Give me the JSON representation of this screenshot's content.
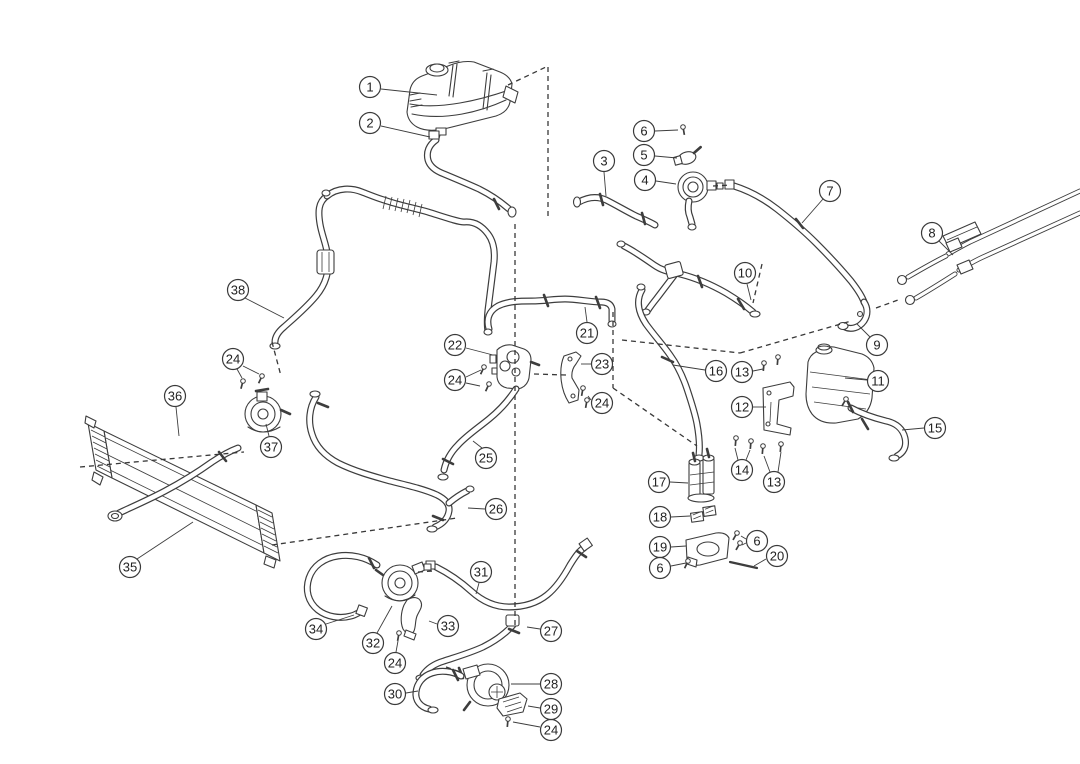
{
  "figure": {
    "canvas": {
      "width": 1080,
      "height": 764
    },
    "colors": {
      "background": "#ffffff",
      "line": "#3d3d3d",
      "callout_fill": "#ffffff",
      "callout_text": "#222222"
    },
    "callout": {
      "radius": 10.5,
      "font_size": 13
    }
  },
  "callouts": [
    {
      "label": "1",
      "x": 370,
      "y": 87,
      "leaders": [
        [
          381,
          89,
          437,
          95
        ]
      ]
    },
    {
      "label": "2",
      "x": 370,
      "y": 123,
      "leaders": [
        [
          381,
          126,
          430,
          137
        ]
      ]
    },
    {
      "label": "3",
      "x": 604,
      "y": 161,
      "leaders": [
        [
          604,
          172,
          606,
          196
        ]
      ]
    },
    {
      "label": "4",
      "x": 645,
      "y": 180,
      "leaders": [
        [
          656,
          181,
          676,
          184
        ]
      ]
    },
    {
      "label": "5",
      "x": 644,
      "y": 155,
      "leaders": [
        [
          655,
          156,
          677,
          158
        ]
      ]
    },
    {
      "label": "6",
      "x": 644,
      "y": 131,
      "leaders": [
        [
          655,
          131,
          678,
          130
        ]
      ]
    },
    {
      "label": "7",
      "x": 830,
      "y": 191,
      "leaders": [
        [
          823,
          199,
          802,
          223
        ]
      ]
    },
    {
      "label": "8",
      "x": 932,
      "y": 233,
      "leaders": [
        [
          939,
          241,
          953,
          255
        ]
      ]
    },
    {
      "label": "9",
      "x": 877,
      "y": 345,
      "leaders": [
        [
          870,
          337,
          857,
          324
        ]
      ]
    },
    {
      "label": "10",
      "x": 745,
      "y": 273,
      "leaders": [
        [
          747,
          284,
          751,
          300
        ]
      ]
    },
    {
      "label": "11",
      "x": 878,
      "y": 381,
      "leaders": [
        [
          867,
          380,
          845,
          378
        ]
      ]
    },
    {
      "label": "12",
      "x": 742,
      "y": 407,
      "leaders": [
        [
          753,
          407,
          766,
          407
        ]
      ]
    },
    {
      "label": "13",
      "x": 742,
      "y": 372,
      "leaders": [
        [
          753,
          371,
          763,
          369
        ]
      ]
    },
    {
      "label": "14",
      "x": 742,
      "y": 470,
      "leaders": [
        [
          738,
          460,
          735,
          448
        ],
        [
          746,
          460,
          750,
          450
        ]
      ]
    },
    {
      "label": "13",
      "x": 774,
      "y": 482,
      "leaders": [
        [
          770,
          472,
          764,
          456
        ],
        [
          778,
          472,
          781,
          452
        ]
      ]
    },
    {
      "label": "15",
      "x": 935,
      "y": 428,
      "leaders": [
        [
          924,
          428,
          902,
          430
        ]
      ]
    },
    {
      "label": "16",
      "x": 716,
      "y": 371,
      "leaders": [
        [
          705,
          370,
          673,
          365
        ]
      ]
    },
    {
      "label": "17",
      "x": 659,
      "y": 482,
      "leaders": [
        [
          670,
          482,
          688,
          483
        ]
      ]
    },
    {
      "label": "18",
      "x": 660,
      "y": 517,
      "leaders": [
        [
          671,
          517,
          690,
          516
        ]
      ]
    },
    {
      "label": "19",
      "x": 660,
      "y": 547,
      "leaders": [
        [
          671,
          547,
          686,
          546
        ]
      ]
    },
    {
      "label": "6",
      "x": 757,
      "y": 541,
      "leaders": [
        [
          746,
          539,
          741,
          536
        ],
        [
          746,
          543,
          742,
          545
        ]
      ]
    },
    {
      "label": "20",
      "x": 777,
      "y": 556,
      "leaders": [
        [
          766,
          559,
          754,
          566
        ]
      ]
    },
    {
      "label": "6",
      "x": 660,
      "y": 568,
      "leaders": [
        [
          671,
          566,
          686,
          563
        ]
      ]
    },
    {
      "label": "21",
      "x": 587,
      "y": 333,
      "leaders": [
        [
          587,
          322,
          585,
          307
        ]
      ]
    },
    {
      "label": "22",
      "x": 455,
      "y": 345,
      "leaders": [
        [
          466,
          348,
          493,
          355
        ]
      ]
    },
    {
      "label": "23",
      "x": 602,
      "y": 364,
      "leaders": [
        [
          591,
          364,
          581,
          364
        ]
      ]
    },
    {
      "label": "24",
      "x": 455,
      "y": 380,
      "leaders": [
        [
          466,
          377,
          481,
          370
        ],
        [
          466,
          383,
          480,
          386
        ]
      ]
    },
    {
      "label": "24",
      "x": 602,
      "y": 403,
      "leaders": [
        [
          591,
          400,
          588,
          396
        ]
      ]
    },
    {
      "label": "24",
      "x": 233,
      "y": 359,
      "leaders": [
        [
          237,
          369,
          242,
          378
        ],
        [
          243,
          366,
          259,
          374
        ]
      ]
    },
    {
      "label": "24",
      "x": 395,
      "y": 663,
      "leaders": [
        [
          396,
          652,
          398,
          641
        ]
      ]
    },
    {
      "label": "24",
      "x": 551,
      "y": 730,
      "leaders": [
        [
          540,
          727,
          513,
          722
        ]
      ]
    },
    {
      "label": "25",
      "x": 486,
      "y": 458,
      "leaders": [
        [
          482,
          448,
          473,
          441
        ]
      ]
    },
    {
      "label": "26",
      "x": 496,
      "y": 509,
      "leaders": [
        [
          485,
          509,
          468,
          508
        ]
      ]
    },
    {
      "label": "27",
      "x": 551,
      "y": 631,
      "leaders": [
        [
          540,
          629,
          527,
          627
        ]
      ]
    },
    {
      "label": "28",
      "x": 551,
      "y": 684,
      "leaders": [
        [
          540,
          684,
          511,
          684
        ]
      ]
    },
    {
      "label": "29",
      "x": 551,
      "y": 709,
      "leaders": [
        [
          540,
          708,
          528,
          706
        ]
      ]
    },
    {
      "label": "30",
      "x": 395,
      "y": 694,
      "leaders": [
        [
          406,
          693,
          418,
          691
        ]
      ]
    },
    {
      "label": "31",
      "x": 481,
      "y": 572,
      "leaders": [
        [
          479,
          583,
          476,
          594
        ]
      ]
    },
    {
      "label": "32",
      "x": 373,
      "y": 643,
      "leaders": [
        [
          377,
          633,
          392,
          606
        ]
      ]
    },
    {
      "label": "33",
      "x": 448,
      "y": 626,
      "leaders": [
        [
          437,
          624,
          429,
          621
        ]
      ]
    },
    {
      "label": "34",
      "x": 316,
      "y": 629,
      "leaders": [
        [
          326,
          624,
          354,
          615
        ]
      ]
    },
    {
      "label": "35",
      "x": 130,
      "y": 567,
      "leaders": [
        [
          137,
          559,
          193,
          522
        ]
      ]
    },
    {
      "label": "36",
      "x": 175,
      "y": 396,
      "leaders": [
        [
          176,
          407,
          179,
          436
        ]
      ]
    },
    {
      "label": "37",
      "x": 271,
      "y": 447,
      "leaders": [
        [
          269,
          436,
          266,
          424
        ]
      ]
    },
    {
      "label": "38",
      "x": 238,
      "y": 290,
      "leaders": [
        [
          245,
          298,
          284,
          318
        ]
      ]
    }
  ],
  "dashed_lines": [
    [
      508,
      85,
      546,
      67
    ],
    [
      548,
      67,
      548,
      218
    ],
    [
      515,
      224,
      515,
      625
    ],
    [
      613,
      312,
      613,
      388
    ],
    [
      613,
      388,
      697,
      446
    ],
    [
      622,
      340,
      740,
      353
    ],
    [
      740,
      353,
      851,
      321
    ],
    [
      534,
      374,
      566,
      375
    ],
    [
      713,
      186,
      731,
      185
    ],
    [
      762,
      264,
      753,
      303
    ],
    [
      876,
      308,
      898,
      300
    ],
    [
      80,
      467,
      244,
      452
    ],
    [
      272,
      545,
      457,
      518
    ],
    [
      272,
      342,
      281,
      376
    ],
    [
      418,
      572,
      433,
      571
    ],
    [
      446,
      667,
      463,
      673
    ]
  ],
  "fasteners": [
    [
      683,
      127,
      80
    ],
    [
      484,
      367,
      115
    ],
    [
      489,
      384,
      115
    ],
    [
      583,
      388,
      100
    ],
    [
      587,
      400,
      100
    ],
    [
      243,
      381,
      105
    ],
    [
      262,
      376,
      115
    ],
    [
      399,
      633,
      100
    ],
    [
      508,
      719,
      95
    ],
    [
      764,
      363,
      95
    ],
    [
      778,
      357,
      95
    ],
    [
      736,
      438,
      95
    ],
    [
      751,
      441,
      95
    ],
    [
      763,
      446,
      95
    ],
    [
      781,
      444,
      95
    ],
    [
      737,
      533,
      120
    ],
    [
      740,
      543,
      120
    ],
    [
      688,
      561,
      115
    ],
    [
      846,
      399,
      120
    ]
  ],
  "pins": [
    [
      730,
      562,
      757,
      568
    ]
  ]
}
